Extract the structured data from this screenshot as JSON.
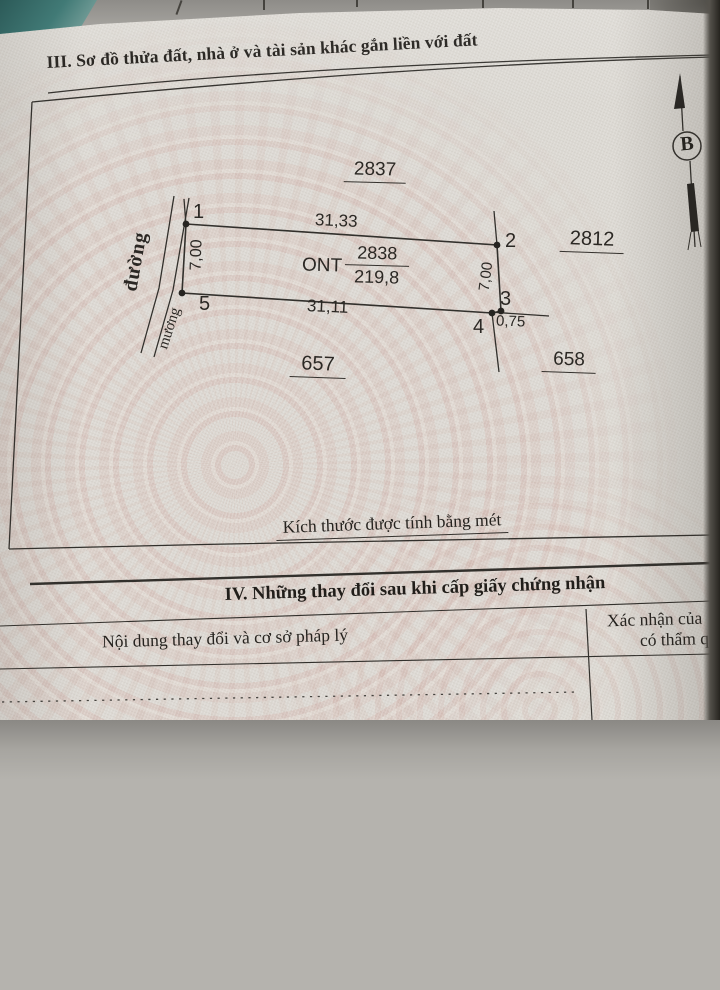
{
  "document": {
    "section3_title": "III. Sơ đồ thửa đất, nhà ở và tài sản khác gắn liền với đất",
    "footnote": "Kích thước được tính bằng mét",
    "section4_title": "IV. Những thay đổi sau khi cấp giấy chứng nhận",
    "table": {
      "col_left": "Nội dung thay đổi và cơ sở pháp lý",
      "col_right_line1": "Xác nhận của",
      "col_right_line2": "có thẩm q"
    }
  },
  "diagram": {
    "north_label": "B",
    "parcel": {
      "land_use_code": "ONT",
      "parcel_number": "2838",
      "area": "219,8"
    },
    "adjacent": {
      "north": "2837",
      "east": "2812",
      "southwest": "657",
      "southeast": "658"
    },
    "points": {
      "p1": "1",
      "p2": "2",
      "p3": "3",
      "p4": "4",
      "p5": "5"
    },
    "dims": {
      "top": "31,33",
      "bottom": "31,11",
      "left": "7,00",
      "right": "7,00",
      "offset": "0,75"
    },
    "features": {
      "road": "đường",
      "canal": "mương"
    }
  }
}
